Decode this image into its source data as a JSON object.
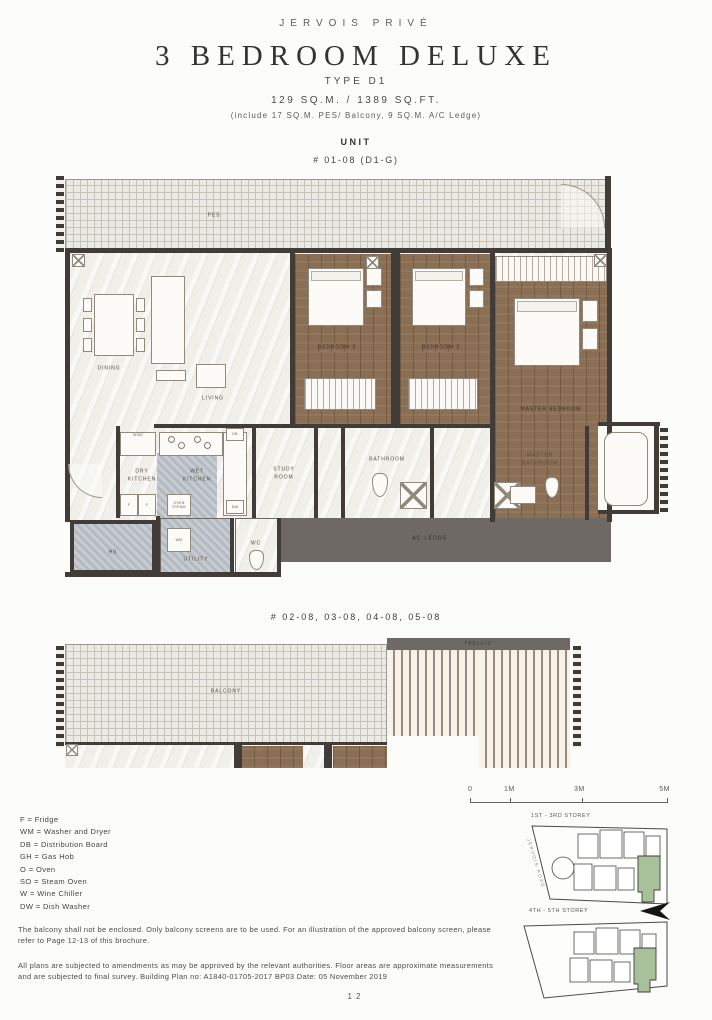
{
  "header": {
    "brand": "JERVOIS PRIVÉ",
    "title": "3 BEDROOM DELUXE",
    "type": "TYPE D1",
    "area": "129 SQ.M. / 1389 SQ.FT.",
    "area_note": "(include 17 SQ.M. PES/ Balcony, 9 SQ.M. A/C Ledge)",
    "unit_label": "UNIT",
    "unit_number": "# 01-08 (D1-G)"
  },
  "plan1": {
    "rooms": {
      "pes": "PES",
      "dining": "DINING",
      "living": "LIVING",
      "bedroom3": "BEDROOM 3",
      "bedroom2": "BEDROOM 2",
      "master_bedroom": "MASTER BEDROOM",
      "dry_kitchen": "DRY KITCHEN",
      "wet_kitchen": "WET KITCHEN",
      "study_room": "STUDY ROOM",
      "bathroom": "BATHROOM",
      "master_bathroom": "MASTER BATHROOM",
      "hs": "HS",
      "utility": "UTILITY",
      "wc": "WC",
      "ac_ledge": "AC LEDGE"
    },
    "markers": {
      "wine": "WINE",
      "fridge_left": "F",
      "fridge_right": "F",
      "oven_steam": "OVEN STEAM",
      "washer": "WM",
      "distribution_board": "DB",
      "dishwasher": "DW"
    }
  },
  "plan2": {
    "heading": "# 02-08, 03-08, 04-08, 05-08",
    "rooms": {
      "balcony": "BALCONY",
      "trellis": "TRELLIS"
    }
  },
  "legend": {
    "items": [
      "F = Fridge",
      "WM = Washer and Dryer",
      "DB = Distribution Board",
      "GH = Gas Hob",
      "O = Oven",
      "SO = Steam Oven",
      "W = Wine Chiller",
      "DW = Dish Washer"
    ]
  },
  "scale_bar": {
    "labels": [
      "0",
      "1M",
      "3M",
      "5M"
    ]
  },
  "key_maps": {
    "first": {
      "label": "1ST - 3RD STOREY",
      "road": "JERVOIS ROAD"
    },
    "second": {
      "label": "4TH - 5TH STOREY"
    }
  },
  "notes": {
    "balcony": "The balcony shall not be enclosed. Only balcony screens are to be used. For an illustration of the approved balcony screen, please refer to Page 12-13 of this brochure.",
    "disclaimer": "All plans are subjected to amendments as may be approved by the relevant authorities. Floor areas are approximate measurements and are subjected to final survey. Building Plan no: A1840-01705-2017 BP03 Date: 05 November 2019"
  },
  "page_number": "12",
  "colors": {
    "wall": "#413c37",
    "wood": "#8b6f55",
    "marble": "#f0efea",
    "ac_ledge": "#6e6964",
    "service_floor": "#bac1c7",
    "highlight_green": "#a9c19b"
  }
}
